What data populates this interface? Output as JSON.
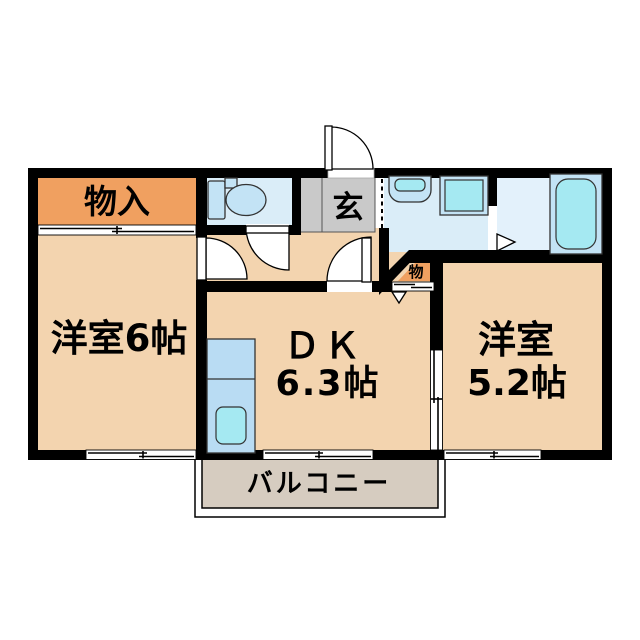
{
  "colors": {
    "wall": "#000000",
    "room_fill": "#F3D4AF",
    "storage_orange": "#F0A060",
    "wet_floor_blue": "#DAEDF8",
    "bath_floor_blue": "#E3F1FB",
    "fixture_blue": "#C3E3F5",
    "fixture_cyan": "#A5E9F2",
    "counter_blue": "#B9DCF3",
    "entrance_gray": "#C9C9C9",
    "balcony_tan": "#D6CCC0"
  },
  "labels": {
    "storage": "物入",
    "entrance": "玄",
    "western_room_left": "洋室6帖",
    "dk_line1": "ＤＫ",
    "dk_line2": "6.3帖",
    "western_room_right_line1": "洋室",
    "western_room_right_line2": "5.2帖",
    "small_closet": "物",
    "balcony": "バルコニー"
  }
}
